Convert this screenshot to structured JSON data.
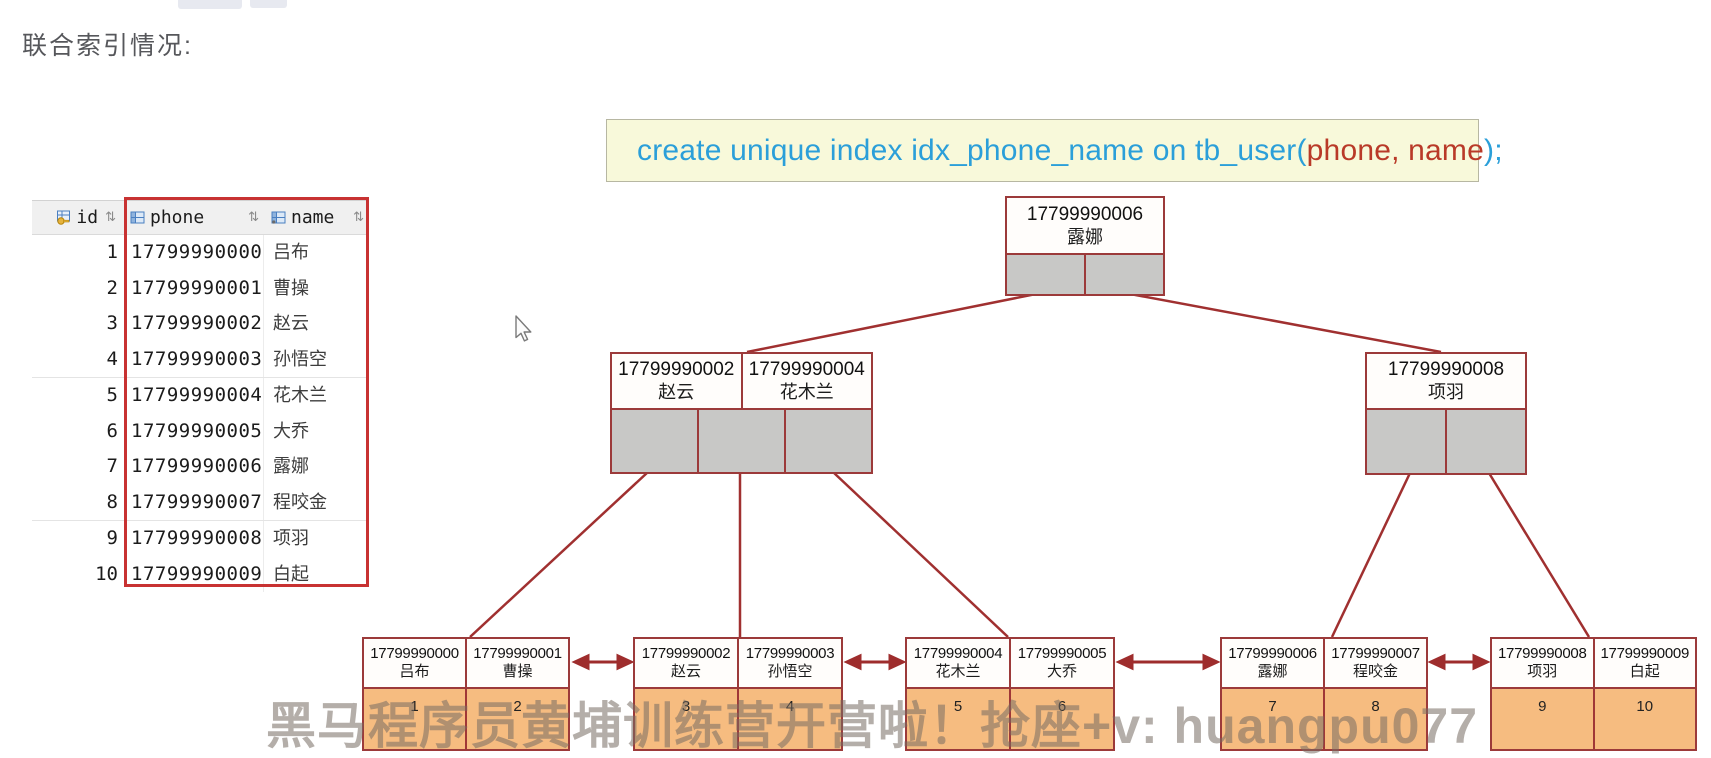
{
  "title": "联合索引情况:",
  "sql": {
    "blue_prefix": "create unique index idx_phone_name on tb_user(",
    "red_columns": "phone, name",
    "blue_suffix": ");"
  },
  "table": {
    "header": {
      "id": "id",
      "phone": "phone",
      "name": "name",
      "sort_glyph": "⇅"
    },
    "rows": [
      {
        "id": "1",
        "phone": "17799990000",
        "name": "吕布"
      },
      {
        "id": "2",
        "phone": "17799990001",
        "name": "曹操"
      },
      {
        "id": "3",
        "phone": "17799990002",
        "name": "赵云"
      },
      {
        "id": "4",
        "phone": "17799990003",
        "name": "孙悟空"
      },
      {
        "id": "5",
        "phone": "17799990004",
        "name": "花木兰"
      },
      {
        "id": "6",
        "phone": "17799990005",
        "name": "大乔"
      },
      {
        "id": "7",
        "phone": "17799990006",
        "name": "露娜"
      },
      {
        "id": "8",
        "phone": "17799990007",
        "name": "程咬金"
      },
      {
        "id": "9",
        "phone": "17799990008",
        "name": "项羽"
      },
      {
        "id": "10",
        "phone": "17799990009",
        "name": "白起"
      }
    ]
  },
  "tree": {
    "root": {
      "phone": "17799990006",
      "name": "露娜"
    },
    "left_node": {
      "key1_phone": "17799990002",
      "key1_name": "赵云",
      "key2_phone": "17799990004",
      "key2_name": "花木兰"
    },
    "right_node": {
      "key_phone": "17799990008",
      "key_name": "项羽"
    },
    "leaves": [
      {
        "e1_phone": "17799990000",
        "e1_name": "吕布",
        "e1_id": "1",
        "e2_phone": "17799990001",
        "e2_name": "曹操",
        "e2_id": "2"
      },
      {
        "e1_phone": "17799990002",
        "e1_name": "赵云",
        "e1_id": "3",
        "e2_phone": "17799990003",
        "e2_name": "孙悟空",
        "e2_id": "4"
      },
      {
        "e1_phone": "17799990004",
        "e1_name": "花木兰",
        "e1_id": "5",
        "e2_phone": "17799990005",
        "e2_name": "大乔",
        "e2_id": "6"
      },
      {
        "e1_phone": "17799990006",
        "e1_name": "露娜",
        "e1_id": "7",
        "e2_phone": "17799990007",
        "e2_name": "程咬金",
        "e2_id": "8"
      },
      {
        "e1_phone": "17799990008",
        "e1_name": "项羽",
        "e1_id": "9",
        "e2_phone": "17799990009",
        "e2_name": "白起",
        "e2_id": "10"
      }
    ]
  },
  "watermark": "黑马程序员黄埔训练营开营啦！抢座+v: huangpu077",
  "colors": {
    "code_blue": "#2b9fd9",
    "code_red": "#b93a28",
    "code_bg": "#f8f9da",
    "tree_border": "#9c3a3a",
    "connector_red": "#a03030",
    "pointer_gray": "#c8c8c6",
    "leaf_orange": "#f6bc80",
    "highlight_box_red": "#c83232"
  }
}
